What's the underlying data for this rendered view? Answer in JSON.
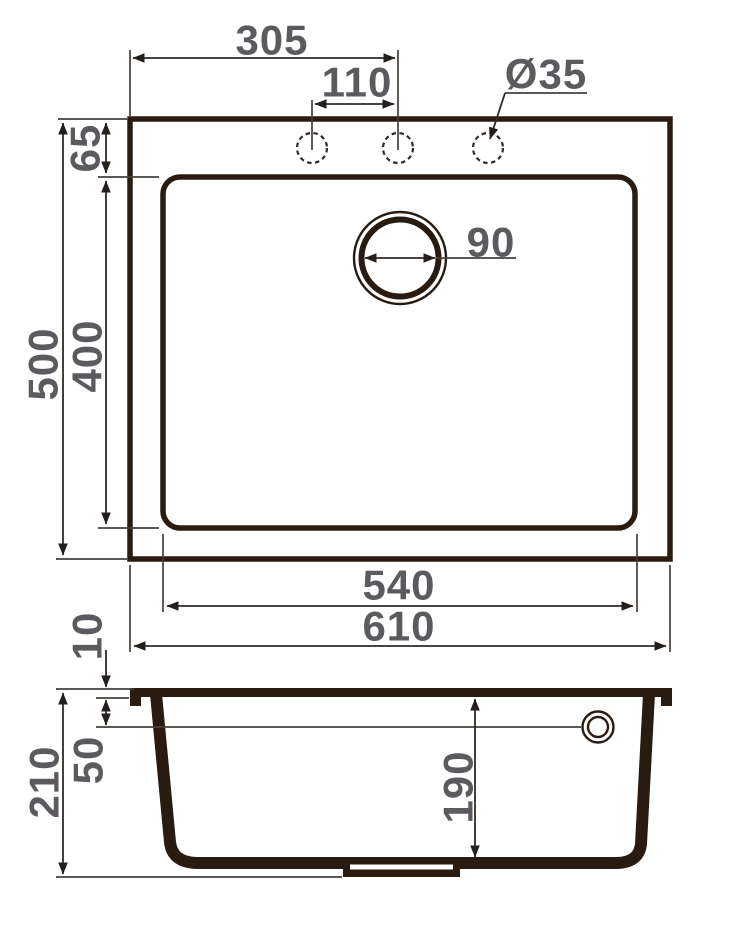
{
  "drawing_title": "Kitchen sink dimensional drawing (top view and cross-section)",
  "units": "mm",
  "colors": {
    "outline": "#2a1b11",
    "thin_line": "#45403c",
    "dimension_line": "#2f2a27",
    "text": "#5d5a5f",
    "background": "#ffffff"
  },
  "dimensions": {
    "top_view": {
      "left_edge_to_tap_center": "305",
      "tap_hole_spacing": "110",
      "tap_hole_diameter": "Ø35",
      "top_edge_to_bowl": "65",
      "drain_diameter": "90",
      "bowl_length": "400",
      "overall_depth": "500",
      "bowl_width": "540",
      "overall_width": "610"
    },
    "side_view": {
      "rim_thickness": "10",
      "top_to_overflow_center": "50",
      "overall_height": "210",
      "bowl_depth": "190"
    }
  }
}
